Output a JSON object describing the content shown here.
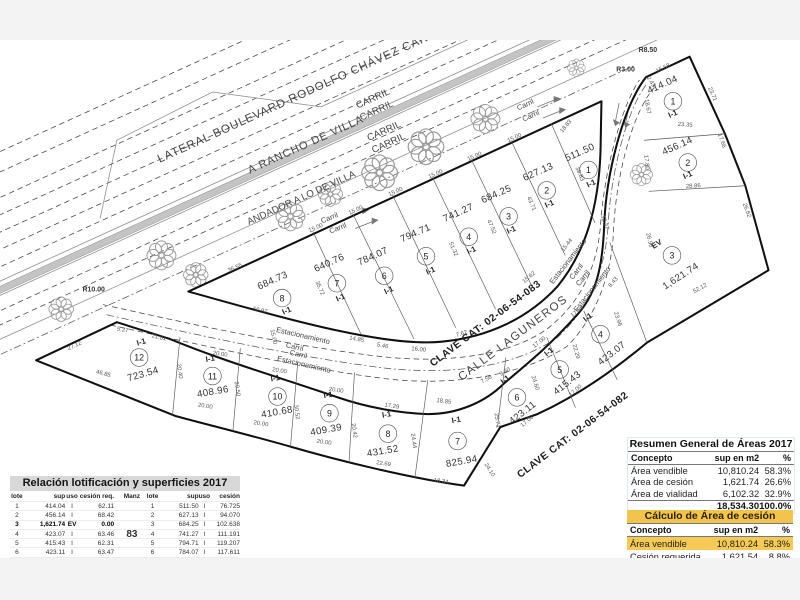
{
  "colors": {
    "page_bg": "#f3f3f4",
    "canvas_bg": "#ffffff",
    "gold": "#f2c44d",
    "median_gray": "#c4c4c4"
  },
  "streets": {
    "lateral": "LATERAL BOULEVARD RODOLFO CHÁVEZ CARRILL",
    "rancho": "A RANCHO DE VILLA",
    "carril_caps": "CARRIL",
    "andador": "ANDADOR A LO DE VILLA",
    "carril": "Carril",
    "estacionamiento": "Estacionamiento",
    "laguneros": "CALLE LAGUNEROS"
  },
  "claves": {
    "a": "CLAVE CAT: 02-06-54-083",
    "b": "CLAVE CAT: 02-06-54-082"
  },
  "radii": {
    "r10": "R10.00",
    "r8": "R8.50",
    "r3": "R3.00"
  },
  "block_a": {
    "lots": [
      {
        "n": "1",
        "area": "511.50",
        "use": "I-1"
      },
      {
        "n": "2",
        "area": "627.13",
        "use": "I-1"
      },
      {
        "n": "3",
        "area": "684.25",
        "use": "I-1"
      },
      {
        "n": "4",
        "area": "741.27",
        "use": "I-1"
      },
      {
        "n": "5",
        "area": "794.71",
        "use": "I-1"
      },
      {
        "n": "6",
        "area": "784.07",
        "use": "I-1"
      },
      {
        "n": "7",
        "area": "640.76",
        "use": "I-1"
      },
      {
        "n": "8",
        "area": "684.73",
        "use": "I-1"
      }
    ]
  },
  "block_b": {
    "lots": [
      {
        "n": "1",
        "area": "414.04",
        "use": "I-1"
      },
      {
        "n": "2",
        "area": "456.14",
        "use": "I-1"
      },
      {
        "n": "3",
        "area": "1,621.74",
        "use": "EV"
      },
      {
        "n": "4",
        "area": "423.07",
        "use": "I-1"
      },
      {
        "n": "5",
        "area": "415.43",
        "use": "I-1"
      },
      {
        "n": "6",
        "area": "423.11",
        "use": "I-1"
      },
      {
        "n": "7",
        "area": "825.94",
        "use": "I-1"
      },
      {
        "n": "8",
        "area": "431.52",
        "use": "I-1"
      },
      {
        "n": "9",
        "area": "409.39",
        "use": "I-1"
      },
      {
        "n": "10",
        "area": "410.68",
        "use": "I-1"
      },
      {
        "n": "11",
        "area": "408.96",
        "use": "I-1"
      },
      {
        "n": "12",
        "area": "723.54",
        "use": "I-1"
      }
    ]
  },
  "dims": [
    "15.00",
    "15.00",
    "15.00",
    "15.00",
    "15.00",
    "15.00",
    "36.55",
    "50.97",
    "18.83",
    "15.44",
    "15.62",
    "39.83",
    "43.71",
    "47.52",
    "51.32",
    "35.72",
    "12.37",
    "5.46",
    "14.85",
    "16.00",
    "15.00",
    "15.68",
    "2.43",
    "23.71",
    "18.67",
    "23.35",
    "17.66",
    "17.80",
    "28.86",
    "26.82",
    "26.98",
    "8.43",
    "23.96",
    "52.12",
    "17.54",
    "22.29",
    "17.00",
    "24.60",
    "17.00",
    "9.50",
    "7.56",
    "7.62",
    "25.71",
    "17.00",
    "18.85",
    "24.10",
    "18.34",
    "24.44",
    "17.29",
    "22.69",
    "20.42",
    "20.00",
    "20.00",
    "30.52",
    "20.00",
    "20.50",
    "20.00",
    "20.00",
    "20.40",
    "20.00",
    "5.27",
    "21.81",
    "27.12",
    "46.85"
  ],
  "tables": {
    "relacion": {
      "title": "Relación lotificación y superficies 2017",
      "headers": [
        "lote",
        "sup",
        "uso",
        "cesión req.",
        "Manz",
        "lote",
        "sup",
        "uso",
        "cesión"
      ],
      "manz": "83",
      "rows": [
        [
          "1",
          "414.04",
          "I",
          "62.11",
          "1",
          "511.50",
          "I",
          "76.725"
        ],
        [
          "2",
          "456.14",
          "I",
          "68.42",
          "2",
          "627.13",
          "I",
          "94.070"
        ],
        [
          "3",
          "1,621.74",
          "EV",
          "0.00",
          "3",
          "684.25",
          "I",
          "102.638"
        ],
        [
          "4",
          "423.07",
          "I",
          "63.46",
          "4",
          "741.27",
          "I",
          "111.191"
        ],
        [
          "5",
          "415.43",
          "I",
          "62.31",
          "5",
          "794.71",
          "I",
          "119.207"
        ],
        [
          "6",
          "423.11",
          "I",
          "63.47",
          "6",
          "784.07",
          "I",
          "117.611"
        ],
        [
          "7",
          "825.94",
          "I",
          "123.89",
          "7",
          "640.76",
          "I",
          "96.114"
        ],
        [
          "8",
          "431.52",
          "I",
          "64.73",
          "8",
          "684.73",
          "I",
          "102.710"
        ]
      ]
    },
    "resumen": {
      "title": "Resumen General de Áreas 2017",
      "headers": [
        "Concepto",
        "sup en m2",
        "%"
      ],
      "rows": [
        [
          "Área vendible",
          "10,810.24",
          "58.3%"
        ],
        [
          "Área de cesión",
          "1,621.74",
          "26.6%"
        ],
        [
          "Área de vialidad",
          "6,102.32",
          "32.9%"
        ]
      ],
      "total": [
        "",
        "18,534.30",
        "100.0%"
      ]
    },
    "calculo": {
      "title": "Cálculo de Área de cesión",
      "headers": [
        "Concepto",
        "sup en m2",
        "%"
      ],
      "rows": [
        [
          "Área vendible",
          "10,810.24",
          "58.3%"
        ],
        [
          "Cesión requerida",
          "1,621.54",
          "8.8%"
        ]
      ]
    }
  }
}
